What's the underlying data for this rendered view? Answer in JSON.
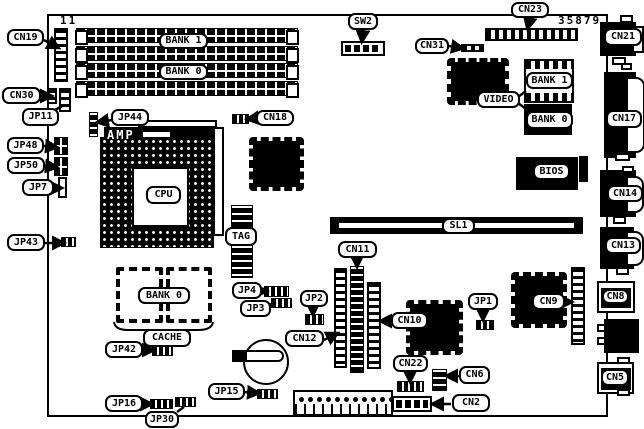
{
  "diagram_title": "motherboard-component-location-diagram",
  "part_number": "35879",
  "colors": {
    "ink": "#000000",
    "paper": "#ffffff"
  },
  "texts": [
    {
      "name": "pin1-indicator-text",
      "text": "11",
      "x": 60,
      "y": 14
    },
    {
      "name": "part-number-text",
      "text": "35879",
      "x": 558,
      "y": 14
    },
    {
      "name": "amp-chip-text",
      "text": "AMP",
      "x": 107,
      "y": 128,
      "inv": true
    }
  ],
  "labels": [
    {
      "name": "label-cn19",
      "text": "CN19",
      "x": 7,
      "y": 29,
      "w": 37,
      "h": 17
    },
    {
      "name": "label-cn30",
      "text": "CN30",
      "x": 2,
      "y": 87,
      "w": 39,
      "h": 17
    },
    {
      "name": "label-jp11",
      "text": "JP11",
      "x": 22,
      "y": 108,
      "w": 37,
      "h": 18
    },
    {
      "name": "label-jp48",
      "text": "JP48",
      "x": 7,
      "y": 137,
      "w": 37,
      "h": 17
    },
    {
      "name": "label-jp50",
      "text": "JP50",
      "x": 7,
      "y": 157,
      "w": 38,
      "h": 17
    },
    {
      "name": "label-jp7",
      "text": "JP7",
      "x": 22,
      "y": 179,
      "w": 32,
      "h": 17
    },
    {
      "name": "label-jp43",
      "text": "JP43",
      "x": 7,
      "y": 234,
      "w": 38,
      "h": 17
    },
    {
      "name": "label-jp44",
      "text": "JP44",
      "x": 111,
      "y": 109,
      "w": 38,
      "h": 17
    },
    {
      "name": "label-cn18",
      "text": "CN18",
      "x": 256,
      "y": 110,
      "w": 38,
      "h": 16
    },
    {
      "name": "label-sw2",
      "text": "SW2",
      "x": 348,
      "y": 13,
      "w": 30,
      "h": 17
    },
    {
      "name": "label-cn31",
      "text": "CN31",
      "x": 415,
      "y": 38,
      "w": 34,
      "h": 16
    },
    {
      "name": "label-cn23",
      "text": "CN23",
      "x": 511,
      "y": 2,
      "w": 38,
      "h": 16
    },
    {
      "name": "label-cn21",
      "text": "CN21",
      "x": 604,
      "y": 28,
      "w": 38,
      "h": 18
    },
    {
      "name": "label-video",
      "text": "VIDEO",
      "x": 477,
      "y": 91,
      "w": 43,
      "h": 17
    },
    {
      "name": "label-bank1-video",
      "text": "BANK 1",
      "x": 526,
      "y": 72,
      "w": 47,
      "h": 17
    },
    {
      "name": "label-bank0-video",
      "text": "BANK 0",
      "x": 526,
      "y": 111,
      "w": 47,
      "h": 18
    },
    {
      "name": "label-cn17",
      "text": "CN17",
      "x": 606,
      "y": 110,
      "w": 36,
      "h": 18
    },
    {
      "name": "label-bios",
      "text": "BIOS",
      "x": 533,
      "y": 163,
      "w": 37,
      "h": 17
    },
    {
      "name": "label-cn14",
      "text": "CN14",
      "x": 607,
      "y": 185,
      "w": 36,
      "h": 17
    },
    {
      "name": "label-cn13",
      "text": "CN13",
      "x": 605,
      "y": 237,
      "w": 36,
      "h": 17
    },
    {
      "name": "label-sl1",
      "text": "SL1",
      "x": 442,
      "y": 218,
      "w": 33,
      "h": 16
    },
    {
      "name": "label-cn11",
      "text": "CN11",
      "x": 338,
      "y": 241,
      "w": 39,
      "h": 17
    },
    {
      "name": "label-cpu",
      "text": "CPU",
      "x": 146,
      "y": 186,
      "w": 35,
      "h": 18
    },
    {
      "name": "label-tag",
      "text": "TAG",
      "x": 225,
      "y": 227,
      "w": 32,
      "h": 19
    },
    {
      "name": "label-bank0-cache",
      "text": "BANK 0",
      "x": 138,
      "y": 287,
      "w": 52,
      "h": 17
    },
    {
      "name": "label-cache",
      "text": "CACHE",
      "x": 143,
      "y": 329,
      "w": 48,
      "h": 18
    },
    {
      "name": "label-jp42",
      "text": "JP42",
      "x": 105,
      "y": 341,
      "w": 38,
      "h": 17
    },
    {
      "name": "label-jp4",
      "text": "JP4",
      "x": 232,
      "y": 282,
      "w": 30,
      "h": 17
    },
    {
      "name": "label-jp3",
      "text": "JP3",
      "x": 240,
      "y": 300,
      "w": 31,
      "h": 17
    },
    {
      "name": "label-jp2",
      "text": "JP2",
      "x": 300,
      "y": 290,
      "w": 28,
      "h": 17
    },
    {
      "name": "label-cn12",
      "text": "CN12",
      "x": 285,
      "y": 330,
      "w": 39,
      "h": 17
    },
    {
      "name": "label-cn10",
      "text": "CN10",
      "x": 391,
      "y": 312,
      "w": 37,
      "h": 17
    },
    {
      "name": "label-jp1",
      "text": "JP1",
      "x": 468,
      "y": 293,
      "w": 30,
      "h": 17
    },
    {
      "name": "label-cn9",
      "text": "CN9",
      "x": 532,
      "y": 293,
      "w": 33,
      "h": 17
    },
    {
      "name": "label-cn8",
      "text": "CN8",
      "x": 602,
      "y": 289,
      "w": 27,
      "h": 15
    },
    {
      "name": "label-cn22",
      "text": "CN22",
      "x": 393,
      "y": 355,
      "w": 35,
      "h": 17
    },
    {
      "name": "label-cn6",
      "text": "CN6",
      "x": 459,
      "y": 366,
      "w": 31,
      "h": 18
    },
    {
      "name": "label-cn2",
      "text": "CN2",
      "x": 452,
      "y": 394,
      "w": 38,
      "h": 18
    },
    {
      "name": "label-cn5",
      "text": "CN5",
      "x": 601,
      "y": 369,
      "w": 28,
      "h": 17
    },
    {
      "name": "label-jp15",
      "text": "JP15",
      "x": 208,
      "y": 383,
      "w": 37,
      "h": 17
    },
    {
      "name": "label-jp16",
      "text": "JP16",
      "x": 105,
      "y": 395,
      "w": 38,
      "h": 17
    },
    {
      "name": "label-jp30",
      "text": "JP30",
      "x": 145,
      "y": 411,
      "w": 34,
      "h": 17
    },
    {
      "name": "label-bank1-simm",
      "text": "BANK 1",
      "x": 159,
      "y": 33,
      "w": 49,
      "h": 16
    },
    {
      "name": "label-bank0-simm",
      "text": "BANK 0",
      "x": 159,
      "y": 64,
      "w": 49,
      "h": 16
    }
  ],
  "components": [
    {
      "name": "board-outline",
      "type": "outline",
      "x": 47,
      "y": 14,
      "w": 561,
      "h": 403
    },
    {
      "name": "simm-slot-1",
      "type": "simm",
      "x": 76,
      "y": 28,
      "w": 222,
      "h": 15
    },
    {
      "name": "simm-slot-2",
      "type": "simm",
      "x": 76,
      "y": 46,
      "w": 222,
      "h": 15
    },
    {
      "name": "simm-slot-3",
      "type": "simm",
      "x": 76,
      "y": 63,
      "w": 222,
      "h": 15
    },
    {
      "name": "simm-slot-4",
      "type": "simm",
      "x": 76,
      "y": 81,
      "w": 222,
      "h": 15
    },
    {
      "name": "cn19-connector",
      "type": "ladderv",
      "x": 54,
      "y": 28,
      "w": 14,
      "h": 54
    },
    {
      "name": "cn30-connector-a",
      "type": "ladderv",
      "x": 47,
      "y": 88,
      "w": 10,
      "h": 16
    },
    {
      "name": "cn30-connector-b",
      "type": "ladderv",
      "x": 59,
      "y": 88,
      "w": 12,
      "h": 24
    },
    {
      "name": "jp44-pins",
      "type": "laddervb",
      "x": 89,
      "y": 112,
      "w": 9,
      "h": 25
    },
    {
      "name": "jp48-block",
      "type": "jblock",
      "x": 54,
      "y": 137,
      "w": 14,
      "h": 18
    },
    {
      "name": "jp50-block",
      "type": "jblock",
      "x": 54,
      "y": 157,
      "w": 14,
      "h": 19
    },
    {
      "name": "jp7-box",
      "type": "whitebox",
      "x": 58,
      "y": 177,
      "w": 9,
      "h": 21
    },
    {
      "name": "jp43-jumper",
      "type": "jmp",
      "x": 61,
      "y": 237,
      "w": 15,
      "h": 10
    },
    {
      "name": "amp-top-bar",
      "type": "whitebox",
      "x": 138,
      "y": 120,
      "w": 79,
      "h": 8
    },
    {
      "name": "amp-chip-bar",
      "type": "black",
      "x": 104,
      "y": 127,
      "w": 113,
      "h": 16
    },
    {
      "name": "amp-slot",
      "type": "whitebox",
      "x": 141,
      "y": 130,
      "w": 31,
      "h": 9
    },
    {
      "name": "cpu-side-bar",
      "type": "whitebox",
      "x": 213,
      "y": 127,
      "w": 11,
      "h": 109
    },
    {
      "name": "cpu-socket",
      "type": "cpu",
      "x": 100,
      "y": 137,
      "w": 114,
      "h": 111
    },
    {
      "name": "cpu-inner",
      "type": "whitebox",
      "x": 132,
      "y": 167,
      "w": 57,
      "h": 60
    },
    {
      "name": "chipset-chip",
      "type": "qfp",
      "x": 249,
      "y": 137,
      "w": 55,
      "h": 54
    },
    {
      "name": "cn18-pins",
      "type": "jmp",
      "x": 232,
      "y": 114,
      "w": 17,
      "h": 10
    },
    {
      "name": "tag-chip-top",
      "type": "laddervb",
      "x": 231,
      "y": 205,
      "w": 22,
      "h": 28
    },
    {
      "name": "tag-chip-bottom",
      "type": "laddervb",
      "x": 231,
      "y": 245,
      "w": 22,
      "h": 33
    },
    {
      "name": "video-chip",
      "type": "qfp",
      "x": 447,
      "y": 58,
      "w": 62,
      "h": 47
    },
    {
      "name": "video-bank1-socket",
      "type": "dipsocket",
      "x": 524,
      "y": 59,
      "w": 50,
      "h": 44
    },
    {
      "name": "video-bank0-chip",
      "type": "black",
      "x": 524,
      "y": 104,
      "w": 48,
      "h": 31
    },
    {
      "name": "bios-chip",
      "type": "black",
      "x": 516,
      "y": 157,
      "w": 62,
      "h": 33
    },
    {
      "name": "right-inner-block",
      "type": "black",
      "x": 579,
      "y": 156,
      "w": 9,
      "h": 26
    },
    {
      "name": "cn23-connector",
      "type": "ladderh",
      "x": 485,
      "y": 28,
      "w": 93,
      "h": 13
    },
    {
      "name": "sw2-dip-switch",
      "type": "dip",
      "x": 341,
      "y": 41,
      "w": 44,
      "h": 15
    },
    {
      "name": "cn31-pins",
      "type": "ladderh",
      "x": 461,
      "y": 44,
      "w": 23,
      "h": 8
    },
    {
      "name": "sl1-slot",
      "type": "sl1",
      "x": 330,
      "y": 217,
      "w": 253,
      "h": 17
    },
    {
      "name": "cn12-connector",
      "type": "ladderv",
      "x": 334,
      "y": 268,
      "w": 13,
      "h": 100
    },
    {
      "name": "cn11-connector",
      "type": "laddervb",
      "x": 350,
      "y": 266,
      "w": 14,
      "h": 107
    },
    {
      "name": "cn10-connector",
      "type": "ladderv",
      "x": 367,
      "y": 282,
      "w": 14,
      "h": 87
    },
    {
      "name": "cn10-chip",
      "type": "qfp",
      "x": 406,
      "y": 300,
      "w": 57,
      "h": 55
    },
    {
      "name": "cn9-chip",
      "type": "qfp",
      "x": 511,
      "y": 272,
      "w": 56,
      "h": 56
    },
    {
      "name": "cn9-connector",
      "type": "ladderv",
      "x": 571,
      "y": 267,
      "w": 14,
      "h": 78
    },
    {
      "name": "jp1-jumper",
      "type": "jmp",
      "x": 476,
      "y": 320,
      "w": 18,
      "h": 10
    },
    {
      "name": "jp2-jumper",
      "type": "jmp",
      "x": 305,
      "y": 314,
      "w": 19,
      "h": 11
    },
    {
      "name": "jp4-jumper",
      "type": "jmp",
      "x": 264,
      "y": 286,
      "w": 25,
      "h": 11
    },
    {
      "name": "jp3-jumper",
      "type": "jmp",
      "x": 271,
      "y": 298,
      "w": 21,
      "h": 10
    },
    {
      "name": "cn22-connector",
      "type": "jmp",
      "x": 397,
      "y": 381,
      "w": 27,
      "h": 11
    },
    {
      "name": "cn6-connector",
      "type": "laddervb",
      "x": 432,
      "y": 369,
      "w": 15,
      "h": 22
    },
    {
      "name": "cn2-connector",
      "type": "dip",
      "x": 392,
      "y": 396,
      "w": 40,
      "h": 16
    },
    {
      "name": "bottom-pin-header",
      "type": "header",
      "x": 293,
      "y": 390,
      "w": 100,
      "h": 26
    },
    {
      "name": "battery",
      "type": "circle",
      "x": 243,
      "y": 339,
      "w": 46,
      "h": 46
    },
    {
      "name": "battery-clip",
      "type": "pen",
      "x": 232,
      "y": 350,
      "w": 52,
      "h": 12
    },
    {
      "name": "cache-chip-1",
      "type": "qfpw",
      "x": 116,
      "y": 267,
      "w": 47,
      "h": 56
    },
    {
      "name": "cache-chip-2",
      "type": "qfpw",
      "x": 166,
      "y": 267,
      "w": 46,
      "h": 56
    },
    {
      "name": "jp42-jumper",
      "type": "jmp",
      "x": 152,
      "y": 346,
      "w": 21,
      "h": 10
    },
    {
      "name": "jp15-jumper",
      "type": "jmp",
      "x": 257,
      "y": 389,
      "w": 21,
      "h": 10
    },
    {
      "name": "jp16-jumper",
      "type": "jmp",
      "x": 150,
      "y": 399,
      "w": 23,
      "h": 10
    },
    {
      "name": "jp30-pins",
      "type": "jmp",
      "x": 175,
      "y": 397,
      "w": 21,
      "h": 10
    },
    {
      "name": "cn21-connector",
      "type": "black",
      "x": 600,
      "y": 22,
      "w": 36,
      "h": 34
    },
    {
      "name": "cn21-port",
      "type": "whitebox",
      "x": 632,
      "y": 26,
      "w": 12,
      "h": 27
    },
    {
      "name": "cn17-connector",
      "type": "black",
      "x": 604,
      "y": 72,
      "w": 32,
      "h": 86
    },
    {
      "name": "cn17-port",
      "type": "dsub",
      "x": 626,
      "y": 77,
      "w": 19,
      "h": 76
    },
    {
      "name": "cn14-connector",
      "type": "black",
      "x": 600,
      "y": 170,
      "w": 36,
      "h": 47
    },
    {
      "name": "cn14-port",
      "type": "dsub",
      "x": 626,
      "y": 176,
      "w": 18,
      "h": 37
    },
    {
      "name": "cn13-connector",
      "type": "black",
      "x": 600,
      "y": 227,
      "w": 34,
      "h": 42
    },
    {
      "name": "cn13-port",
      "type": "dsub",
      "x": 626,
      "y": 231,
      "w": 18,
      "h": 35
    },
    {
      "name": "cn8-box",
      "type": "whitebox",
      "x": 597,
      "y": 281,
      "w": 38,
      "h": 32
    },
    {
      "name": "cn8-inner",
      "type": "black",
      "x": 601,
      "y": 288,
      "w": 30,
      "h": 20
    },
    {
      "name": "edge-black-connector",
      "type": "black",
      "x": 604,
      "y": 319,
      "w": 35,
      "h": 34
    },
    {
      "name": "edge-tab-a",
      "type": "whitebox",
      "x": 597,
      "y": 324,
      "w": 9,
      "h": 8
    },
    {
      "name": "edge-tab-b",
      "type": "whitebox",
      "x": 597,
      "y": 337,
      "w": 9,
      "h": 8
    },
    {
      "name": "cn5-box",
      "type": "whitebox",
      "x": 597,
      "y": 362,
      "w": 37,
      "h": 32
    },
    {
      "name": "cn5-inner",
      "type": "black",
      "x": 601,
      "y": 368,
      "w": 30,
      "h": 22
    },
    {
      "name": "edge-tab-1",
      "type": "whitebox",
      "x": 620,
      "y": 15,
      "w": 13,
      "h": 8
    },
    {
      "name": "edge-tab-2",
      "type": "whitebox",
      "x": 612,
      "y": 57,
      "w": 14,
      "h": 8
    },
    {
      "name": "edge-tab-3",
      "type": "whitebox",
      "x": 621,
      "y": 63,
      "w": 11,
      "h": 7
    },
    {
      "name": "edge-tab-4",
      "type": "whitebox",
      "x": 615,
      "y": 153,
      "w": 15,
      "h": 8
    },
    {
      "name": "edge-tab-5",
      "type": "whitebox",
      "x": 622,
      "y": 166,
      "w": 12,
      "h": 7
    },
    {
      "name": "edge-tab-6",
      "type": "whitebox",
      "x": 613,
      "y": 216,
      "w": 13,
      "h": 8
    },
    {
      "name": "edge-tab-7",
      "type": "whitebox",
      "x": 616,
      "y": 267,
      "w": 13,
      "h": 8
    },
    {
      "name": "edge-tab-8",
      "type": "whitebox",
      "x": 617,
      "y": 357,
      "w": 13,
      "h": 7
    },
    {
      "name": "edge-tab-9",
      "type": "whitebox",
      "x": 617,
      "y": 389,
      "w": 13,
      "h": 7
    }
  ],
  "leaders": [
    {
      "x1": 44,
      "y1": 40,
      "x2": 57,
      "y2": 47,
      "arrow": true
    },
    {
      "x1": 41,
      "y1": 96,
      "x2": 50,
      "y2": 96,
      "arrow": true
    },
    {
      "x1": 55,
      "y1": 110,
      "x2": 64,
      "y2": 105,
      "arrow": false
    },
    {
      "x1": 44,
      "y1": 146,
      "x2": 55,
      "y2": 147,
      "arrow": true
    },
    {
      "x1": 45,
      "y1": 166,
      "x2": 55,
      "y2": 167,
      "arrow": true
    },
    {
      "x1": 54,
      "y1": 188,
      "x2": 60,
      "y2": 188,
      "arrow": true
    },
    {
      "x1": 45,
      "y1": 243,
      "x2": 62,
      "y2": 243,
      "arrow": true
    },
    {
      "x1": 112,
      "y1": 120,
      "x2": 99,
      "y2": 122,
      "arrow": true
    },
    {
      "x1": 257,
      "y1": 118,
      "x2": 249,
      "y2": 119,
      "arrow": true
    },
    {
      "x1": 363,
      "y1": 30,
      "x2": 362,
      "y2": 40,
      "arrow": true
    },
    {
      "x1": 449,
      "y1": 46,
      "x2": 461,
      "y2": 48,
      "arrow": true
    },
    {
      "x1": 530,
      "y1": 18,
      "x2": 528,
      "y2": 27,
      "arrow": true
    },
    {
      "x1": 518,
      "y1": 97,
      "x2": 526,
      "y2": 91,
      "arrow": false
    },
    {
      "x1": 518,
      "y1": 103,
      "x2": 526,
      "y2": 109,
      "arrow": false
    },
    {
      "x1": 357,
      "y1": 258,
      "x2": 357,
      "y2": 265,
      "arrow": true
    },
    {
      "x1": 324,
      "y1": 340,
      "x2": 336,
      "y2": 334,
      "arrow": true
    },
    {
      "x1": 392,
      "y1": 321,
      "x2": 382,
      "y2": 321,
      "arrow": true
    },
    {
      "x1": 313,
      "y1": 307,
      "x2": 313,
      "y2": 313,
      "arrow": true
    },
    {
      "x1": 260,
      "y1": 291,
      "x2": 265,
      "y2": 291,
      "arrow": true
    },
    {
      "x1": 269,
      "y1": 305,
      "x2": 276,
      "y2": 302,
      "arrow": false
    },
    {
      "x1": 483,
      "y1": 310,
      "x2": 483,
      "y2": 318,
      "arrow": true
    },
    {
      "x1": 564,
      "y1": 302,
      "x2": 570,
      "y2": 302,
      "arrow": true
    },
    {
      "x1": 410,
      "y1": 372,
      "x2": 410,
      "y2": 380,
      "arrow": true
    },
    {
      "x1": 459,
      "y1": 376,
      "x2": 448,
      "y2": 376,
      "arrow": true
    },
    {
      "x1": 451,
      "y1": 404,
      "x2": 434,
      "y2": 404,
      "arrow": true
    },
    {
      "x1": 141,
      "y1": 350,
      "x2": 152,
      "y2": 350,
      "arrow": true
    },
    {
      "x1": 244,
      "y1": 392,
      "x2": 257,
      "y2": 393,
      "arrow": true
    },
    {
      "x1": 142,
      "y1": 404,
      "x2": 150,
      "y2": 404,
      "arrow": true
    },
    {
      "x1": 177,
      "y1": 412,
      "x2": 184,
      "y2": 407,
      "arrow": false
    }
  ],
  "brace_path": "M114,322 Q115,330 128,330 L150,330 Q162,330 163,336 Q164,330 176,330 L198,330 Q212,330 213,322"
}
